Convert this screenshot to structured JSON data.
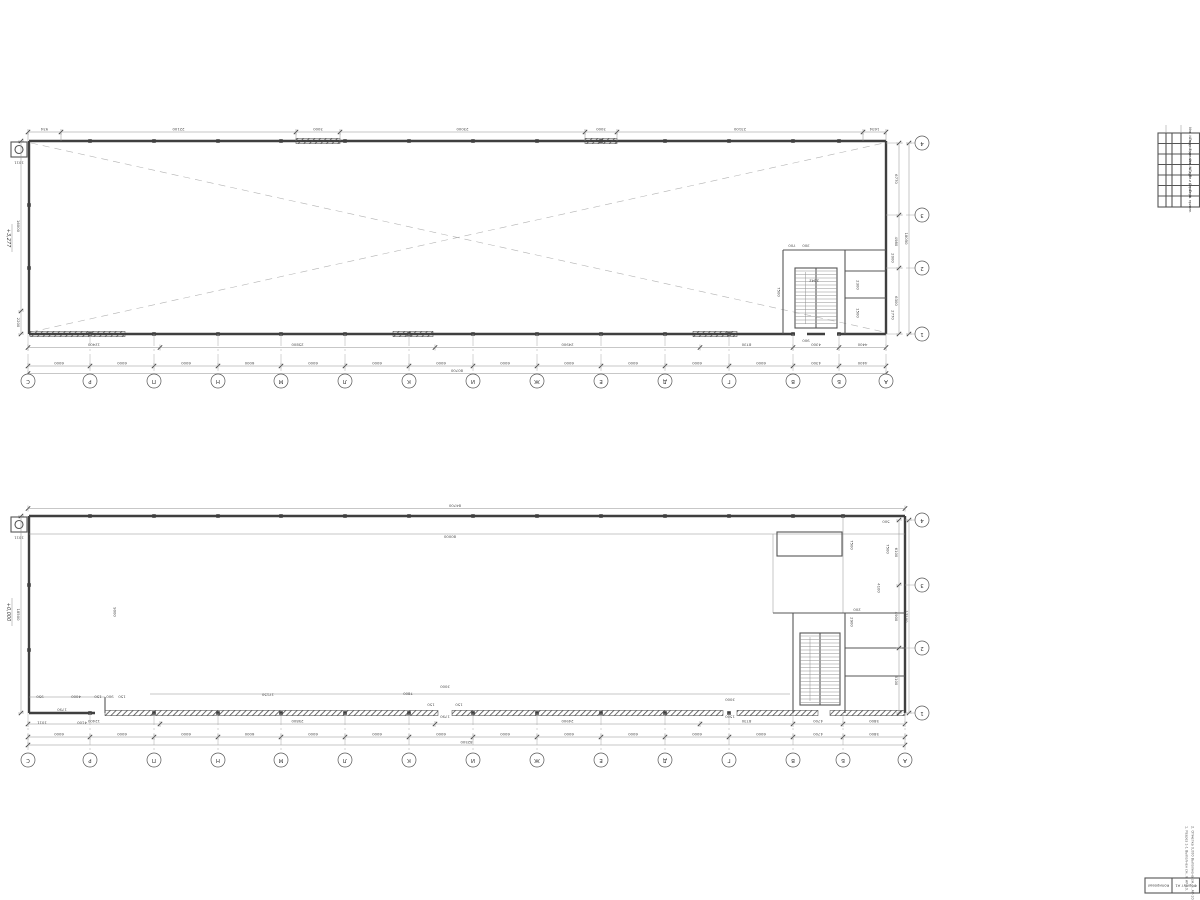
{
  "sheet": {
    "background": "#ffffff",
    "line_color": "#8f8f8f",
    "wall_color": "#3f3f3f",
    "text_color": "#4a4a4a",
    "notes": [
      "1. Разрез 1-1 Выполнен см. л. АР-10.",
      "2. Отметка 0,000 Выполнена см. л. АР-10."
    ],
    "footer": {
      "copied": "Копировал",
      "format": "Формат А1"
    },
    "stamp_rows": [
      "Инв. № подл.",
      "Подп. и дата",
      "Взам. инв. №",
      "Инв. № дубл.",
      "Подп. и дата",
      "Справ. №",
      "Перв. примен."
    ]
  },
  "plan_upper": {
    "elevation": "+3,277",
    "corner_label": "1011",
    "axes_letters": [
      "С",
      "Р",
      "П",
      "Н",
      "М",
      "Л",
      "К",
      "И",
      "Ж",
      "Е",
      "Д",
      "Г",
      "В",
      "Б",
      "А"
    ],
    "axes_numbers": [
      "4",
      "3",
      "2",
      "1"
    ],
    "top_dims": [
      "934",
      "22100",
      "3000",
      "23000",
      "3000",
      "23100",
      "1634"
    ],
    "sub_dims": [
      "12400",
      "25800",
      "24900",
      "8730",
      "4300",
      "4400"
    ],
    "axis_spans": [
      "6000",
      "6000",
      "6000",
      "6000",
      "6000",
      "6000",
      "6000",
      "6000",
      "6000",
      "6000",
      "6000",
      "6000",
      "4300",
      "4400"
    ],
    "total": "80700",
    "left_dims": [
      "16000",
      "2200"
    ],
    "right_dims": [
      "6770",
      "4980",
      "6300"
    ],
    "right_total": "18050",
    "misc_dims": [
      "7500",
      "2642",
      "2300",
      "1500",
      "2770",
      "2000",
      "700",
      "300",
      "900"
    ]
  },
  "plan_lower": {
    "elevation": "+0,000",
    "corner_label": "1011",
    "axes_letters": [
      "С",
      "Р",
      "П",
      "Н",
      "М",
      "Л",
      "К",
      "И",
      "Ж",
      "Е",
      "Д",
      "Г",
      "В",
      "Б",
      "А"
    ],
    "axes_numbers": [
      "4",
      "3",
      "2",
      "1"
    ],
    "sub_dims": [
      "12400",
      "25800",
      "24900",
      "8730",
      "4700",
      "5800"
    ],
    "axis_spans": [
      "6000",
      "6000",
      "6000",
      "6000",
      "6000",
      "6000",
      "6000",
      "6000",
      "6000",
      "6000",
      "6000",
      "6000",
      "4700",
      "5800"
    ],
    "total": "82500",
    "left_dims": [
      "18500"
    ],
    "right_dims": [
      "6100",
      "4900",
      "6100"
    ],
    "right_total": "17100",
    "misc_dims": [
      "84700",
      "80000",
      "500",
      "7500",
      "7500",
      "4100",
      "2900",
      "200",
      "17150",
      "7800",
      "3000",
      "150",
      "150",
      "1790",
      "3000",
      "1500",
      "950",
      "4000",
      "150",
      "900",
      "150",
      "1790",
      "4100",
      "1011",
      "9000"
    ]
  }
}
